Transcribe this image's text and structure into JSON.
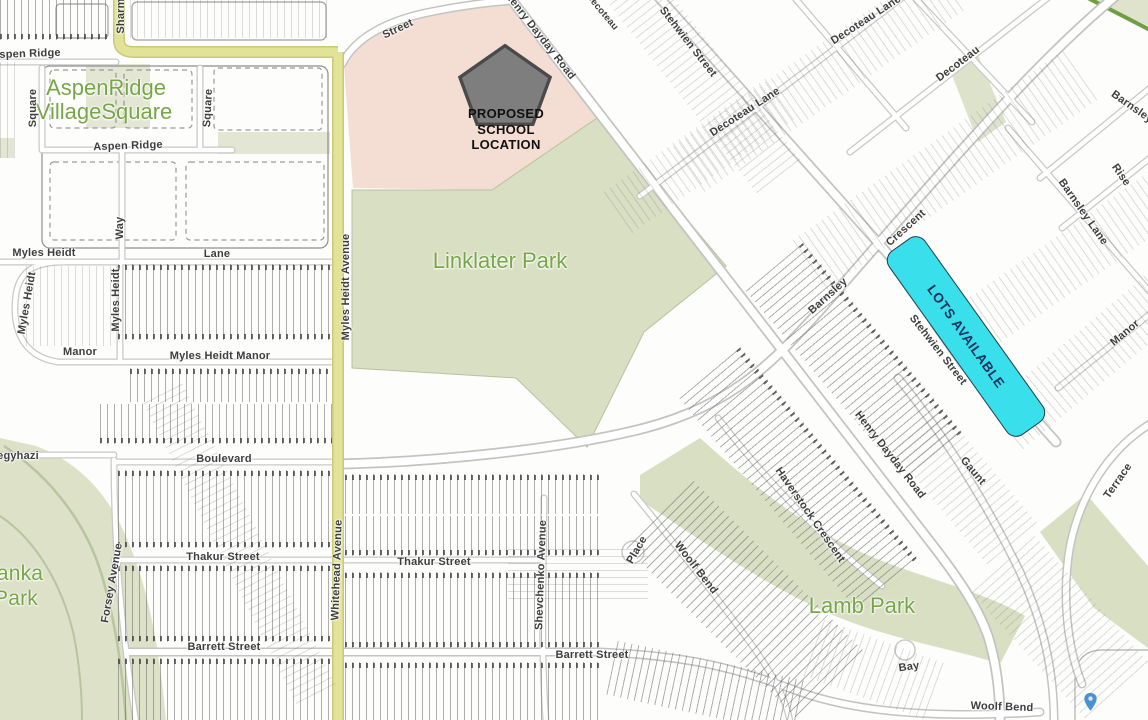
{
  "map": {
    "school_marker": {
      "lines": [
        "PROPOSED",
        "SCHOOL",
        "LOCATION"
      ]
    },
    "lots_available_label": "LOTS AVAILABLE",
    "colors": {
      "park_fill": "#d8dfc3",
      "park_fill_light": "#e2e6d3",
      "school_site_fill": "#f4ddd3",
      "major_road_fill": "#e3e398",
      "major_road_edge": "#c9c97a",
      "lots_available_fill": "#3adfec",
      "lots_available_text": "#14325e",
      "pentagon_fill": "#7e7e7e",
      "pentagon_border": "#4a4a4a",
      "park_label_text": "#78a548",
      "street_label_text": "#3e3e3e",
      "trail_green": "#6f9e43",
      "pin_blue": "#4a90d2"
    },
    "labels": [
      {
        "text": "AspenRidge",
        "x": 106,
        "y": 88,
        "rot": 0,
        "cls": "park"
      },
      {
        "text": "VillageSquare",
        "x": 104,
        "y": 112,
        "rot": 0,
        "cls": "park"
      },
      {
        "text": "Linklater Park",
        "x": 500,
        "y": 261,
        "rot": 0,
        "cls": "park"
      },
      {
        "text": "Lamb Park",
        "x": 862,
        "y": 606,
        "rot": 0,
        "cls": "park"
      },
      {
        "text": "anka",
        "x": 20,
        "y": 574,
        "rot": 0,
        "cls": "park-md"
      },
      {
        "text": "Park",
        "x": 16,
        "y": 599,
        "rot": 0,
        "cls": "park-md"
      },
      {
        "text": "Aspen Ridge",
        "x": 26,
        "y": 54,
        "rot": -2
      },
      {
        "text": "Sharm",
        "x": 121,
        "y": 16,
        "rot": -90
      },
      {
        "text": "Aspen Ridge",
        "x": 128,
        "y": 146,
        "rot": -2
      },
      {
        "text": "Square",
        "x": 33,
        "y": 108,
        "rot": -90
      },
      {
        "text": "Square",
        "x": 208,
        "y": 108,
        "rot": -87
      },
      {
        "text": "Way",
        "x": 120,
        "y": 228,
        "rot": -90
      },
      {
        "text": "Street",
        "x": 398,
        "y": 29,
        "rot": -25
      },
      {
        "text": "Henry Dayday Road",
        "x": 540,
        "y": 36,
        "rot": 52
      },
      {
        "text": "Decoteau",
        "x": 602,
        "y": 12,
        "rot": 50,
        "cls": "sm"
      },
      {
        "text": "Stehwien Street",
        "x": 688,
        "y": 42,
        "rot": 52
      },
      {
        "text": "Decoteau Lane",
        "x": 745,
        "y": 112,
        "rot": -33
      },
      {
        "text": "Decoteau Lane",
        "x": 866,
        "y": 20,
        "rot": -33
      },
      {
        "text": "Decoteau",
        "x": 958,
        "y": 64,
        "rot": -37
      },
      {
        "text": "Barnsley",
        "x": 1132,
        "y": 107,
        "rot": 35
      },
      {
        "text": "Rise",
        "x": 1121,
        "y": 175,
        "rot": 55
      },
      {
        "text": "Barnsley Lane",
        "x": 1083,
        "y": 212,
        "rot": 55
      },
      {
        "text": "Manor",
        "x": 1125,
        "y": 333,
        "rot": -40
      },
      {
        "text": "Myles Heidt",
        "x": 44,
        "y": 253,
        "rot": 0
      },
      {
        "text": "Lane",
        "x": 217,
        "y": 254,
        "rot": 0
      },
      {
        "text": "Myles Heidt",
        "x": 27,
        "y": 303,
        "rot": -80
      },
      {
        "text": "Myles Heidt",
        "x": 116,
        "y": 300,
        "rot": -90
      },
      {
        "text": "Myles Heidt Avenue",
        "x": 346,
        "y": 287,
        "rot": -90
      },
      {
        "text": "Manor",
        "x": 80,
        "y": 352,
        "rot": 0
      },
      {
        "text": "Myles Heidt Manor",
        "x": 220,
        "y": 356,
        "rot": 0
      },
      {
        "text": "Boulevard",
        "x": 224,
        "y": 459,
        "rot": 0
      },
      {
        "text": "egyhazi",
        "x": 18,
        "y": 456,
        "rot": 0
      },
      {
        "text": "Barnsley",
        "x": 828,
        "y": 296,
        "rot": -42
      },
      {
        "text": "Crescent",
        "x": 906,
        "y": 228,
        "rot": -42
      },
      {
        "text": "Stehwien Street",
        "x": 938,
        "y": 350,
        "rot": 52
      },
      {
        "text": "Henry Dayday Road",
        "x": 890,
        "y": 455,
        "rot": 52
      },
      {
        "text": "Gaunt",
        "x": 973,
        "y": 471,
        "rot": 50
      },
      {
        "text": "Haverstock Crescent",
        "x": 810,
        "y": 515,
        "rot": 55
      },
      {
        "text": "Terrace",
        "x": 1118,
        "y": 481,
        "rot": -55
      },
      {
        "text": "Whitehead Avenue",
        "x": 337,
        "y": 570,
        "rot": -88
      },
      {
        "text": "Forsey Avenue",
        "x": 112,
        "y": 583,
        "rot": -80
      },
      {
        "text": "Thakur Street",
        "x": 223,
        "y": 557,
        "rot": 0
      },
      {
        "text": "Thakur Street",
        "x": 434,
        "y": 562,
        "rot": 0
      },
      {
        "text": "Shevchenko Avenue",
        "x": 541,
        "y": 575,
        "rot": -88
      },
      {
        "text": "Place",
        "x": 637,
        "y": 550,
        "rot": -60
      },
      {
        "text": "Woolf Bend",
        "x": 696,
        "y": 568,
        "rot": 52
      },
      {
        "text": "Barrett Street",
        "x": 224,
        "y": 647,
        "rot": 0
      },
      {
        "text": "Barrett Street",
        "x": 592,
        "y": 655,
        "rot": 0
      },
      {
        "text": "Bay",
        "x": 909,
        "y": 667,
        "rot": -8
      },
      {
        "text": "Woolf Bend",
        "x": 1002,
        "y": 707,
        "rot": 2
      }
    ]
  }
}
